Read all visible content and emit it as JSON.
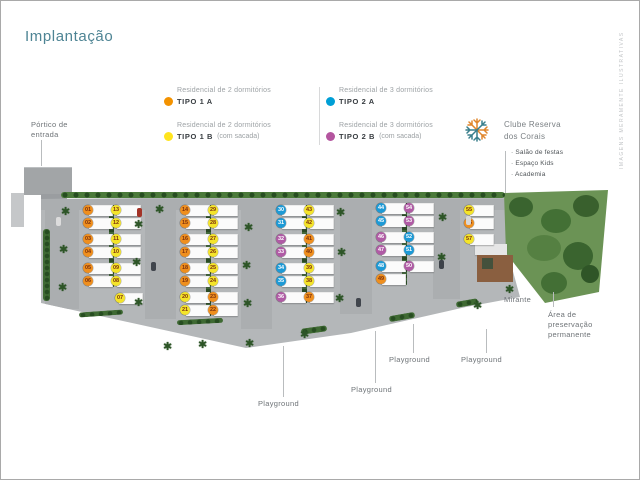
{
  "title": "Implantação",
  "side_note": "IMAGENS MERAMENTE ILUSTRATIVAS",
  "legend": {
    "items": [
      {
        "desc": "Residencial de 2 dormitórios",
        "name": "TIPO 1 A",
        "suffix": "",
        "color": "#f39200"
      },
      {
        "desc": "Residencial de 2 dormitórios",
        "name": "TIPO 1 B",
        "suffix": "(com sacada)",
        "color": "#ffe41e"
      },
      {
        "desc": "Residencial de 3 dormitórios",
        "name": "TIPO 2 A",
        "suffix": "",
        "color": "#009fd6"
      },
      {
        "desc": "Residencial de 3 dormitórios",
        "name": "TIPO 2 B",
        "suffix": "(com sacada)",
        "color": "#b4559f"
      }
    ]
  },
  "club": {
    "name": "Clube Reserva\ndos Corais",
    "amenities": [
      "Salão de festas",
      "Espaço Kids",
      "Academia"
    ]
  },
  "labels": {
    "portico": "Pórtico de\nentrada",
    "mirante": "Mirante",
    "preservation": "Área de\npreservação\npermanente",
    "playground": "Playground"
  },
  "unit_colors": {
    "tipo1a": "#ef8f1e",
    "tipo1b": "#f4e42a",
    "tipo2a": "#1d9ad6",
    "tipo2b": "#b05ba5"
  },
  "unit_text_colors": {
    "tipo1a": "#7c300d",
    "tipo1b": "#7c300d",
    "tipo2a": "#ffffff",
    "tipo2b": "#ffffff"
  },
  "map": {
    "clusters": [
      {
        "name": "quadra-1",
        "left": [
          {
            "n": "01",
            "t": "tipo1a"
          },
          {
            "n": "02",
            "t": "tipo1a"
          },
          {
            "n": "03",
            "t": "tipo1a"
          },
          {
            "n": "04",
            "t": "tipo1a"
          },
          {
            "n": "05",
            "t": "tipo1a"
          },
          {
            "n": "06",
            "t": "tipo1a"
          }
        ],
        "right": [
          {
            "n": "13",
            "t": "tipo1b"
          },
          {
            "n": "12",
            "t": "tipo1b"
          },
          {
            "n": "11",
            "t": "tipo1b"
          },
          {
            "n": "10",
            "t": "tipo1b"
          },
          {
            "n": "09",
            "t": "tipo1b"
          },
          {
            "n": "08",
            "t": "tipo1b"
          }
        ],
        "extra": [
          {
            "n": "07",
            "t": "tipo1b"
          }
        ]
      },
      {
        "name": "quadra-2",
        "left": [
          {
            "n": "14",
            "t": "tipo1a"
          },
          {
            "n": "15",
            "t": "tipo1a"
          },
          {
            "n": "16",
            "t": "tipo1a"
          },
          {
            "n": "17",
            "t": "tipo1a"
          },
          {
            "n": "18",
            "t": "tipo1a"
          },
          {
            "n": "19",
            "t": "tipo1a"
          },
          {
            "n": "20",
            "t": "tipo1b"
          },
          {
            "n": "21",
            "t": "tipo1b"
          }
        ],
        "right": [
          {
            "n": "29",
            "t": "tipo1b"
          },
          {
            "n": "28",
            "t": "tipo1b"
          },
          {
            "n": "27",
            "t": "tipo1b"
          },
          {
            "n": "26",
            "t": "tipo1b"
          },
          {
            "n": "25",
            "t": "tipo1b"
          },
          {
            "n": "24",
            "t": "tipo1b"
          },
          {
            "n": "23",
            "t": "tipo1a"
          },
          {
            "n": "22",
            "t": "tipo1a"
          }
        ],
        "extra": []
      },
      {
        "name": "quadra-3",
        "left": [
          {
            "n": "30",
            "t": "tipo2a"
          },
          {
            "n": "31",
            "t": "tipo2a"
          },
          {
            "n": "32",
            "t": "tipo2b"
          },
          {
            "n": "33",
            "t": "tipo2b"
          },
          {
            "n": "34",
            "t": "tipo2a"
          },
          {
            "n": "35",
            "t": "tipo2a"
          },
          {
            "n": "36",
            "t": "tipo2b"
          }
        ],
        "right": [
          {
            "n": "43",
            "t": "tipo1b"
          },
          {
            "n": "42",
            "t": "tipo1b"
          },
          {
            "n": "41",
            "t": "tipo1a"
          },
          {
            "n": "40",
            "t": "tipo1a"
          },
          {
            "n": "39",
            "t": "tipo1b"
          },
          {
            "n": "38",
            "t": "tipo1b"
          },
          {
            "n": "37",
            "t": "tipo1a"
          }
        ],
        "extra": []
      },
      {
        "name": "quadra-4",
        "left": [
          {
            "n": "44",
            "t": "tipo2a"
          },
          {
            "n": "45",
            "t": "tipo2a"
          },
          {
            "n": "46",
            "t": "tipo2b"
          },
          {
            "n": "47",
            "t": "tipo2b"
          },
          {
            "n": "48",
            "t": "tipo2a"
          },
          {
            "n": "49",
            "t": "tipo1a"
          }
        ],
        "right": [
          {
            "n": "54",
            "t": "tipo2b"
          },
          {
            "n": "53",
            "t": "tipo2b"
          },
          {
            "n": "52",
            "t": "tipo2a"
          },
          {
            "n": "51",
            "t": "tipo2a"
          },
          {
            "n": "50",
            "t": "tipo2b"
          }
        ],
        "extra": []
      },
      {
        "name": "quadra-5",
        "left": [
          {
            "n": "55",
            "t": "tipo1b"
          },
          {
            "n": "56",
            "t": "tipo1a"
          },
          {
            "n": "57",
            "t": "tipo1b"
          }
        ],
        "right": [],
        "extra": []
      }
    ]
  }
}
